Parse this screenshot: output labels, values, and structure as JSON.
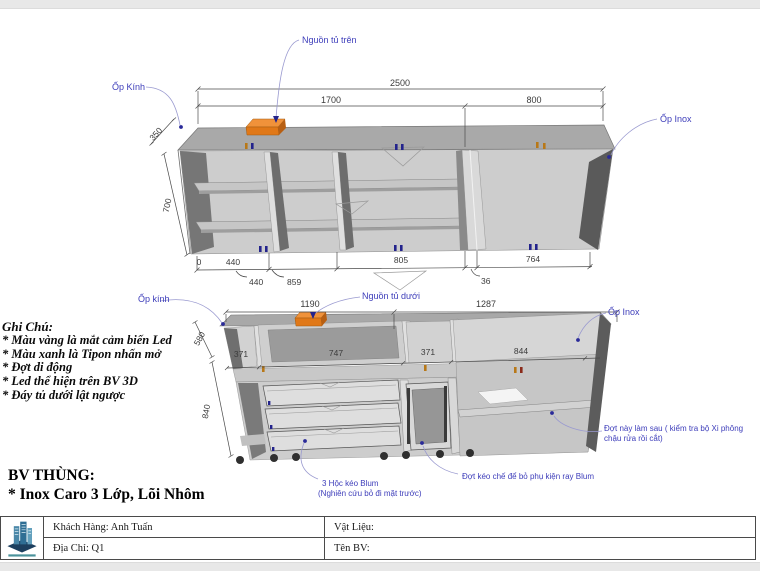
{
  "upper": {
    "label_glass": "Ốp Kính",
    "label_power": "Nguồn tủ trên",
    "label_inox": "Ốp Inox",
    "dim_overall": "2500",
    "dim_left": "1700",
    "dim_right": "800",
    "dim_depth": "350",
    "dim_height": "700",
    "dim_zero": "0",
    "dim_b1": "440",
    "dim_b2": "805",
    "dim_b3": "764",
    "dim_r2a": "440",
    "dim_r2b": "859",
    "dim_r2c": "36"
  },
  "lower": {
    "label_glass": "Ốp kính",
    "label_power": "Nguồn tủ dưới",
    "label_inox": "Ốp Inox",
    "dim_left": "1190",
    "dim_right": "1287",
    "dim_w1": "371",
    "dim_w2": "747",
    "dim_w3": "371",
    "dim_w4": "844",
    "dim_h_top": "580",
    "dim_h_bottom": "840",
    "note_shelf_1": "Đợt này làm sau ( kiểm tra bộ Xi phông",
    "note_shelf_2": "chậu rửa rồi cắt)",
    "note_drawer_1": "3 Hộc kéo Blum",
    "note_drawer_2": "(Nghiên cứu bỏ đi mặt trước)",
    "note_rail": "Đợt kéo chế để bỏ phụ kiện ray Blum"
  },
  "notes": {
    "title": "Ghi Chú:",
    "items": [
      "* Màu vàng là mắt cảm biến Led",
      "* Màu xanh là Tipon nhấn mở",
      "* Đợt di động",
      "* Led thể hiện trên BV 3D",
      "* Đáy tủ dưới lật ngược"
    ]
  },
  "title_block": {
    "heading1": "BV THÙNG:",
    "heading2": "* Inox Caro 3 Lớp, Lõi Nhôm",
    "customer": "Khách Hàng: Anh Tuấn",
    "material": "Vật Liệu:",
    "address": "Địa Chỉ: Q1",
    "drawing_name": "Tên BV:"
  },
  "colors": {
    "label_blue": "#3d3dba",
    "accent_orange": "#e8821e",
    "cabinet_gray": "#cdcdcd"
  }
}
